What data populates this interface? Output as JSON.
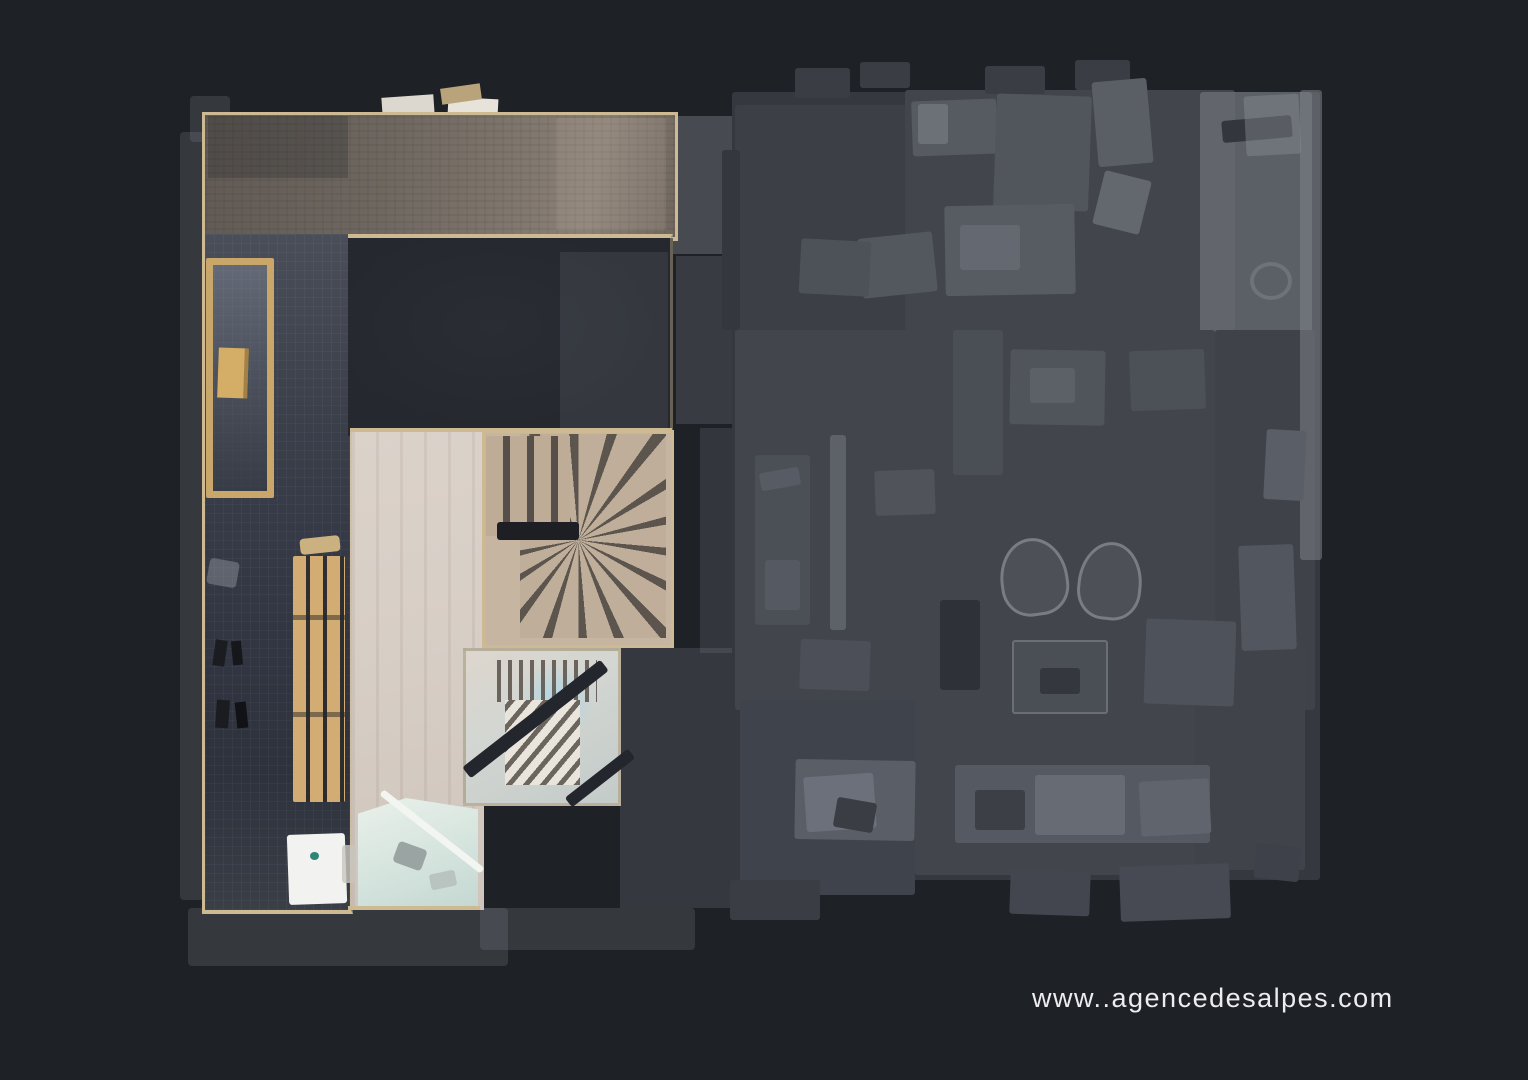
{
  "watermark": {
    "text": "www..agencedesalpes.com"
  },
  "colors": {
    "bg": "#1e2125",
    "wall": "#cdb992",
    "tan-stair": "#c6b5a1",
    "tread": "#57504a",
    "bench": "#d2ac72",
    "rad-wood": "#c9a76a",
    "bath": "#d7e5df",
    "fixture": "#f2f2f0",
    "teal": "#2e8578",
    "faded-base": "#42454b",
    "faded-dark": "#3c3f45",
    "faded-light": "#565a61",
    "faded-lighter": "#6c7077",
    "faded-outline": "#787c84",
    "watermark": "#ededef"
  }
}
